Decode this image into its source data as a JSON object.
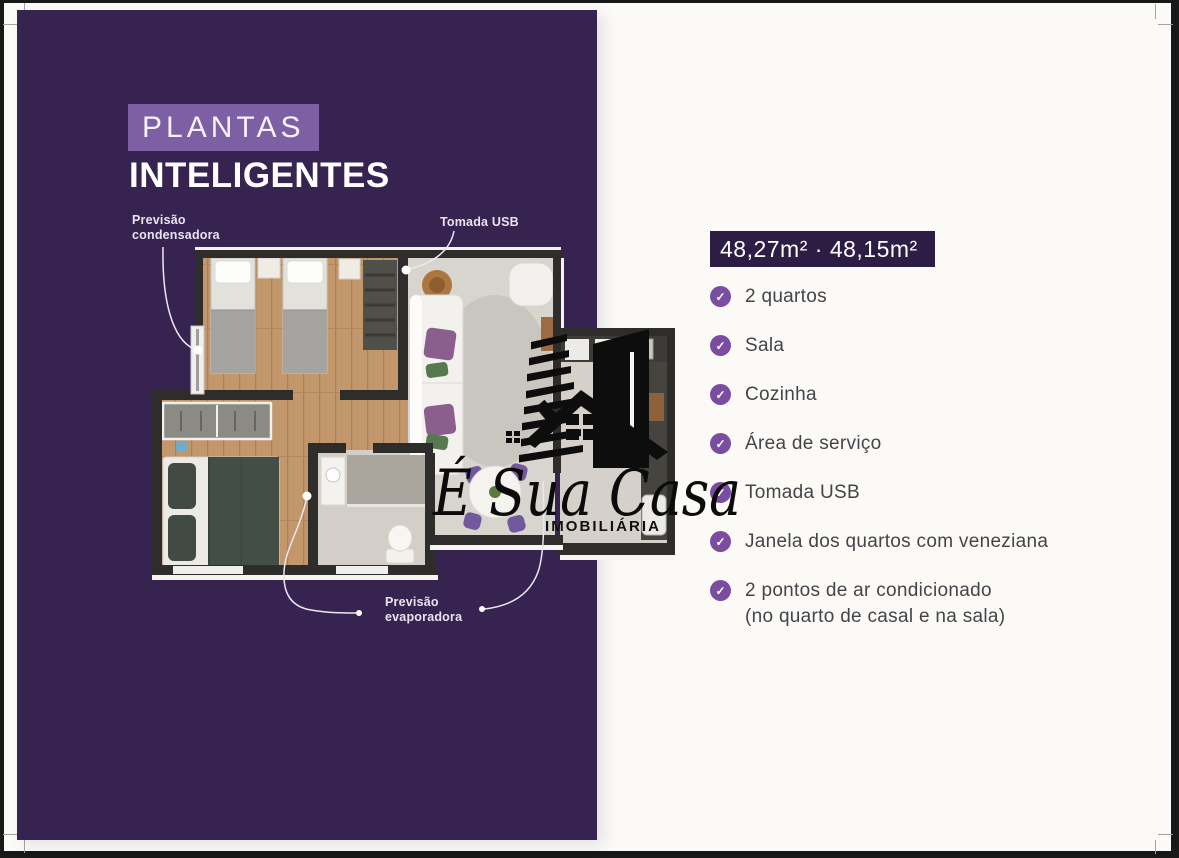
{
  "colors": {
    "panel_purple": "#372350",
    "highlight_purple": "#7d5fa4",
    "badge_purple": "#2d1c44",
    "check_purple": "#7a4da1",
    "feature_text": "#45444a"
  },
  "left_panel": {
    "title_highlight": "PLANTAS",
    "title_main": "INTELIGENTES",
    "callout_condensadora_line1": "Previsão",
    "callout_condensadora_line2": "condensadora",
    "callout_tomada_usb": "Tomada USB",
    "callout_evaporadora_line1": "Previsão",
    "callout_evaporadora_line2": "evaporadora"
  },
  "logo": {
    "script_name": "É Sua Casa",
    "subtitle": "IMOBILIÁRIA"
  },
  "right_panel": {
    "area_badge": "48,27m² · 48,15m²",
    "check_glyph": "✓",
    "features": [
      {
        "label": "2 quartos"
      },
      {
        "label": "Sala"
      },
      {
        "label": "Cozinha"
      },
      {
        "label": "Área de serviço"
      },
      {
        "label": "Tomada USB"
      },
      {
        "label": "Janela dos quartos com veneziana"
      },
      {
        "label": "2 pontos de ar condicionado",
        "label2": "(no quarto de casal e na sala)"
      }
    ]
  }
}
